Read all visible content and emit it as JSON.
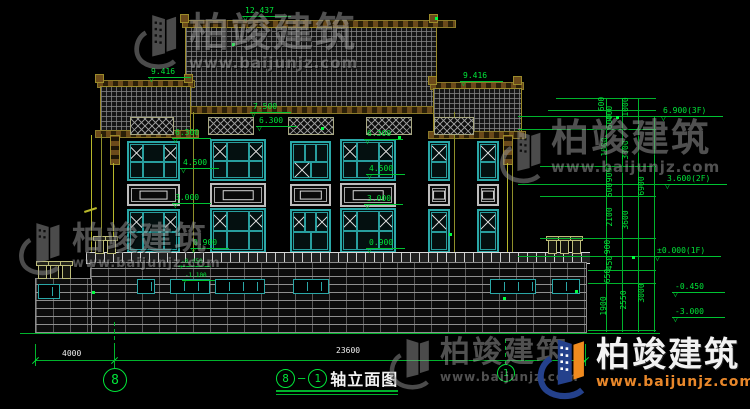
{
  "watermark": {
    "brand": "柏竣建筑",
    "url": "www.baijunjz.com"
  },
  "title": {
    "bubble_left": "8",
    "dash": "—",
    "bubble_right": "1",
    "text": "轴立面图"
  },
  "grid": {
    "left_bubble": "8",
    "right_bubble": "1"
  },
  "bottom_dims": {
    "left": "4000",
    "main": "23600"
  },
  "colors": {
    "cad_green": "#00e639",
    "cad_olive": "#8f8f2a",
    "window_teal": "#2aa7a7",
    "logo_blue": "#24418c",
    "logo_orange": "#f08a1e"
  },
  "elevation_markers": [
    {
      "t": "12.437",
      "x": 242,
      "y": 16,
      "w": 44
    },
    {
      "t": "9.416",
      "x": 148,
      "y": 77,
      "w": 38
    },
    {
      "t": "9.416",
      "x": 460,
      "y": 81,
      "w": 38
    },
    {
      "t": "7.500",
      "x": 250,
      "y": 112,
      "w": 36
    },
    {
      "t": "6.300",
      "x": 256,
      "y": 126,
      "w": 36
    },
    {
      "t": "6.300",
      "x": 172,
      "y": 138,
      "w": 34
    },
    {
      "t": "4.500",
      "x": 180,
      "y": 168,
      "w": 34
    },
    {
      "t": "3.000",
      "x": 172,
      "y": 203,
      "w": 34
    },
    {
      "t": "0.900",
      "x": 190,
      "y": 248,
      "w": 34
    },
    {
      "t": "6.300",
      "x": 364,
      "y": 139,
      "w": 34
    },
    {
      "t": "4.500",
      "x": 366,
      "y": 174,
      "w": 34
    },
    {
      "t": "3.000",
      "x": 364,
      "y": 204,
      "w": 34
    },
    {
      "t": "0.900",
      "x": 366,
      "y": 248,
      "w": 34
    },
    {
      "t": "-0.450",
      "x": 178,
      "y": 266,
      "w": 28,
      "s": 1
    },
    {
      "t": "-1.100",
      "x": 182,
      "y": 280,
      "w": 28,
      "s": 1
    },
    {
      "t": "6.900(3F)",
      "x": 660,
      "y": 116,
      "w": 58
    },
    {
      "t": "3.600(2F)",
      "x": 664,
      "y": 184,
      "w": 58
    },
    {
      "t": "±0.000(1F)",
      "x": 654,
      "y": 256,
      "w": 62
    },
    {
      "t": "-0.450",
      "x": 672,
      "y": 292,
      "w": 48
    },
    {
      "t": "-3.000",
      "x": 672,
      "y": 317,
      "w": 48
    }
  ],
  "vdim_labels": [
    {
      "t": "600",
      "x": 598,
      "y": 104
    },
    {
      "t": "400",
      "x": 606,
      "y": 113
    },
    {
      "t": "1000",
      "x": 622,
      "y": 107
    },
    {
      "t": "600",
      "x": 606,
      "y": 122
    },
    {
      "t": "1800",
      "x": 601,
      "y": 147
    },
    {
      "t": "3300",
      "x": 622,
      "y": 150
    },
    {
      "t": "900",
      "x": 606,
      "y": 175
    },
    {
      "t": "600",
      "x": 606,
      "y": 190
    },
    {
      "t": "2100",
      "x": 606,
      "y": 217
    },
    {
      "t": "3600",
      "x": 622,
      "y": 220
    },
    {
      "t": "6900",
      "x": 638,
      "y": 186
    },
    {
      "t": "900",
      "x": 604,
      "y": 247
    },
    {
      "t": "450",
      "x": 606,
      "y": 263
    },
    {
      "t": "650",
      "x": 604,
      "y": 276
    },
    {
      "t": "1900",
      "x": 600,
      "y": 306
    },
    {
      "t": "2550",
      "x": 620,
      "y": 300
    },
    {
      "t": "3000",
      "x": 638,
      "y": 293
    }
  ],
  "hdim_labels": [
    {
      "t": "4000",
      "x": 62,
      "y": 350
    },
    {
      "t": "23600",
      "x": 336,
      "y": 347
    }
  ],
  "dots": [
    {
      "x": 232,
      "y": 43
    },
    {
      "x": 321,
      "y": 127
    },
    {
      "x": 398,
      "y": 136
    },
    {
      "x": 449,
      "y": 233
    },
    {
      "x": 575,
      "y": 290
    },
    {
      "x": 92,
      "y": 291
    },
    {
      "x": 435,
      "y": 17
    },
    {
      "x": 503,
      "y": 297
    },
    {
      "x": 616,
      "y": 116
    },
    {
      "x": 632,
      "y": 256
    }
  ]
}
